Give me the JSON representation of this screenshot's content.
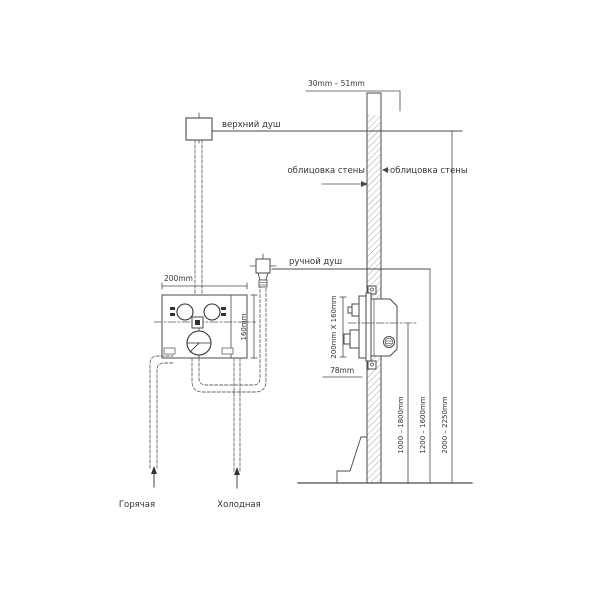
{
  "front_view": {
    "overhead_shower_label": "верхний душ",
    "hand_shower_label": "ручной душ",
    "hot_water_label": "Горячая",
    "cold_water_label": "Холодная",
    "mixer_box_width": "200mm",
    "mixer_box_height": "160mm"
  },
  "side_view": {
    "wall_thickness_range": "30mm  –  51mm",
    "wall_cladding_left": "облицовка стены",
    "wall_cladding_right": "облицовка стены",
    "valve_plate_size": "200mm X 160mm",
    "valve_depth": "78mm",
    "valve_center_height_range": "1000 – 1800mm",
    "hand_shower_height_range": "1200 – 1600mm",
    "overhead_shower_height_range": "2000 – 2250mm"
  }
}
